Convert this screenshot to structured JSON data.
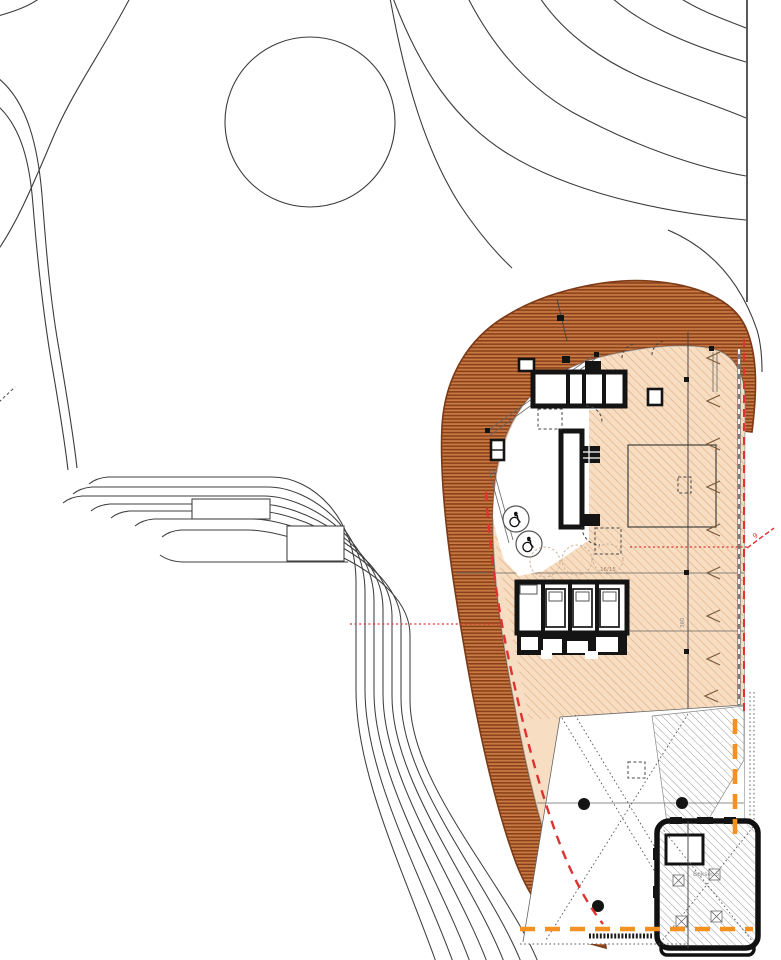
{
  "drawing": {
    "kind": "architectural site plan with landscaped berm, building interior and outbuilding",
    "labels": {
      "lot_number": "16/15",
      "section_marker": "9",
      "outbuilding_label": "Bokser 5",
      "dimension_vertical": "360"
    },
    "colors": {
      "background": "#ffffff",
      "contour_line": "#3c3c3c",
      "wall_black": "#141414",
      "band_base": "#c97a44",
      "band_stripe": "#8a4119",
      "band_outline": "#7c3a16",
      "floor_tan": "#f7ddc2",
      "floor_hatch": "#dfa877",
      "gray_hatch": "#9b9b9b",
      "boundary_red": "#e03232",
      "boundary_orange": "#f59120",
      "thin_gray": "#8c8c8c"
    },
    "icons": {
      "accessible_wc_1": "wheelchair-icon",
      "accessible_wc_2": "wheelchair-icon"
    }
  }
}
